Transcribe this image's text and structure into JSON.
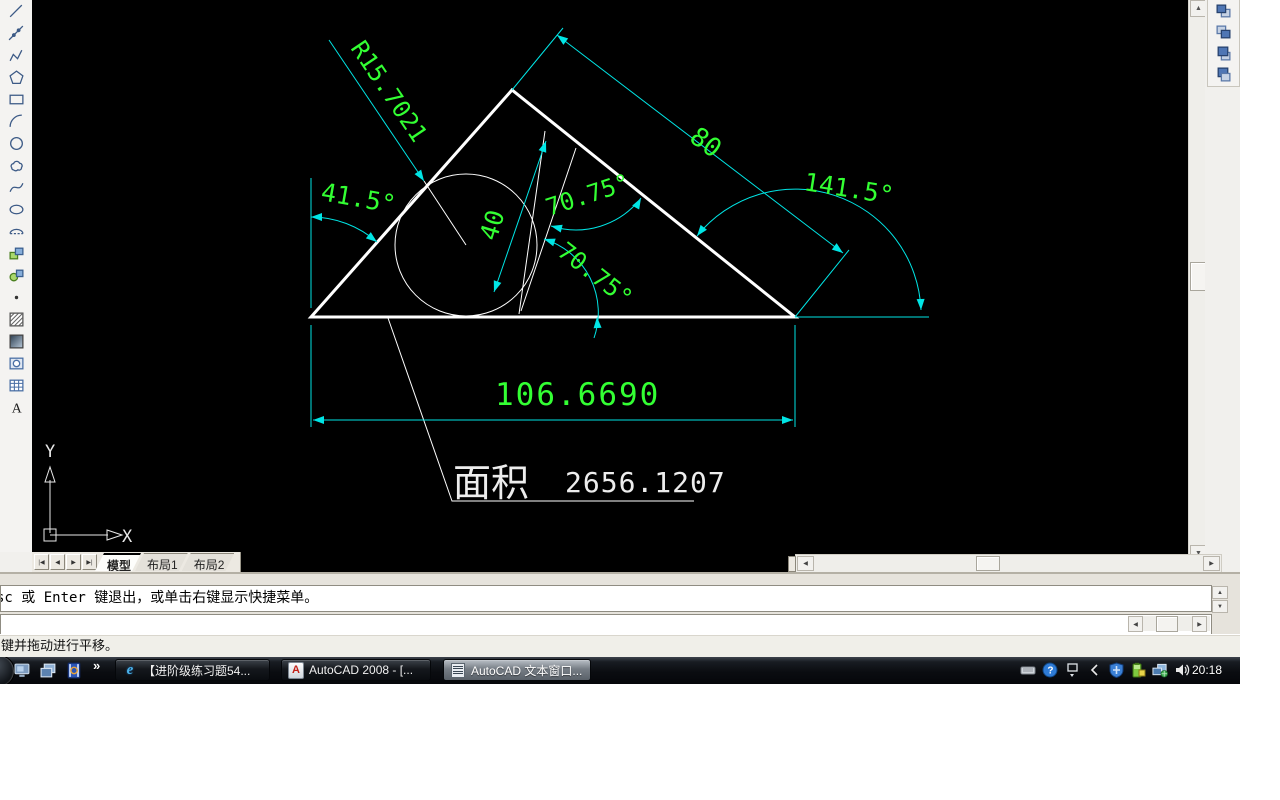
{
  "drawing": {
    "dim_radius": "R15.7021",
    "dim_side": "80",
    "dim_angle_left": "41.5°",
    "dim_angle_right": "141.5°",
    "dim_segment": "40",
    "dim_angle_upper": "70.75°",
    "dim_angle_lower": "70.75°",
    "dim_base": "106.6690",
    "area_label": "面积",
    "area_value": "2656.1207",
    "axis_x": "X",
    "axis_y": "Y",
    "colors": {
      "geometry": "#ffffff",
      "dimension": "#00e5e5",
      "dim_text": "#33ff33",
      "background": "#000000"
    }
  },
  "toolbars": {
    "draw": {
      "items": [
        "line",
        "construction-line",
        "polyline",
        "polygon",
        "rectangle",
        "arc",
        "circle",
        "revision-cloud",
        "spline",
        "ellipse",
        "ellipse-arc",
        "insert-block",
        "make-block",
        "point",
        "hatch",
        "gradient",
        "region",
        "table",
        "multiline-text"
      ]
    },
    "draworder": {
      "items": [
        "bring-to-front",
        "send-to-back",
        "bring-above-objects",
        "send-under-objects"
      ]
    }
  },
  "layout_tabs": {
    "nav": [
      "|◀",
      "◀",
      "▶",
      "▶|"
    ],
    "tabs": [
      {
        "label": "模型",
        "active": true
      },
      {
        "label": "布局1",
        "active": false
      },
      {
        "label": "布局2",
        "active": false
      }
    ]
  },
  "command": {
    "history_line": "sc 或 Enter 键退出，或单击右键显示快捷菜单。",
    "input_value": ""
  },
  "statusbar": {
    "message": "键并拖动进行平移。"
  },
  "taskbar": {
    "quicklaunch": [
      "show-desktop",
      "window-switcher",
      "media-player"
    ],
    "more_chevron": "»",
    "buttons": [
      {
        "icon": "ie",
        "label": "【进阶级练习题54...",
        "active": false
      },
      {
        "icon": "autocad",
        "label": "AutoCAD 2008 - [...",
        "active": false
      },
      {
        "icon": "text-window",
        "label": "AutoCAD 文本窗口...",
        "active": true
      }
    ],
    "tray_icons": [
      "keyboard",
      "help",
      "restore-window",
      "chevron-left",
      "security-shield",
      "battery",
      "network",
      "volume"
    ],
    "clock": "20:18"
  }
}
